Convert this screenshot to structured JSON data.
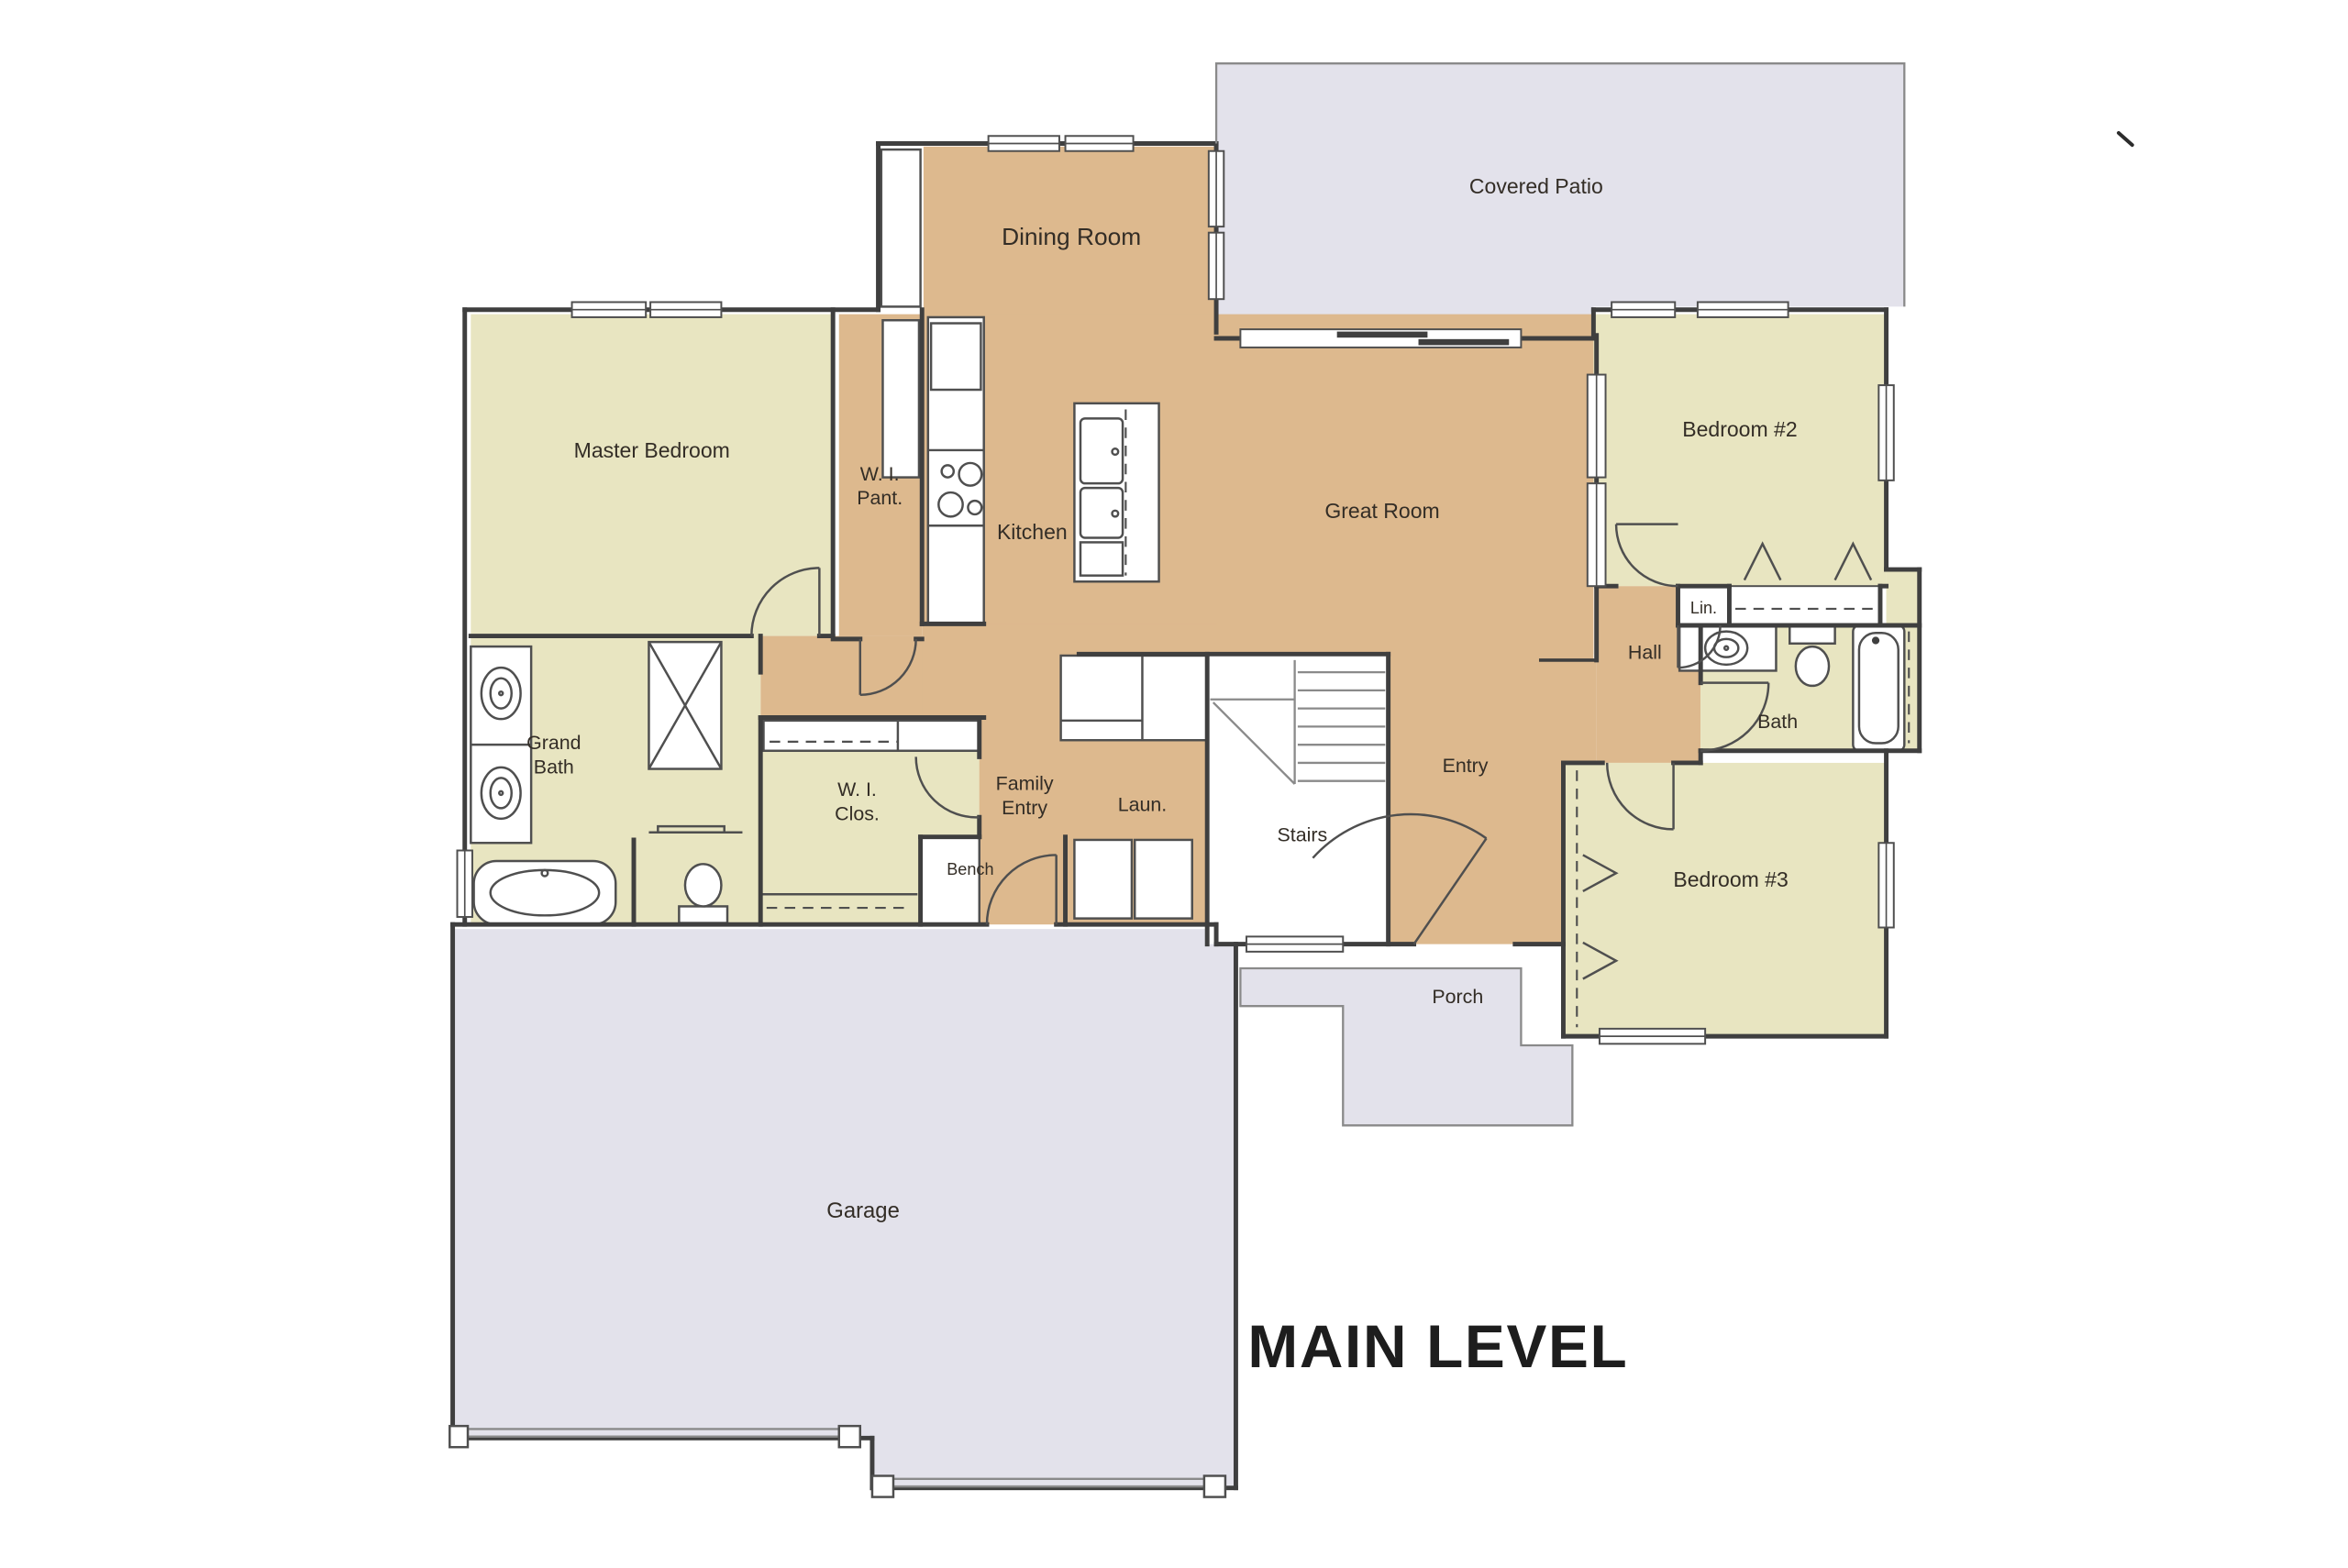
{
  "title": {
    "label": "MAIN LEVEL"
  },
  "rooms": {
    "covered_patio": {
      "label": "Covered Patio"
    },
    "dining_room": {
      "label": "Dining Room"
    },
    "master_bedroom": {
      "label": "Master Bedroom"
    },
    "walk_in_pantry": {
      "label": "W. I.",
      "label2": "Pant."
    },
    "kitchen": {
      "label": "Kitchen"
    },
    "great_room": {
      "label": "Great Room"
    },
    "bedroom_2": {
      "label": "Bedroom #2"
    },
    "linen": {
      "label": "Lin."
    },
    "hall": {
      "label": "Hall"
    },
    "bath": {
      "label": "Bath"
    },
    "grand_bath": {
      "label": "Grand",
      "label2": "Bath"
    },
    "walk_in_closet": {
      "label": "W. I.",
      "label2": "Clos."
    },
    "family_entry": {
      "label": "Family",
      "label2": "Entry"
    },
    "laundry": {
      "label": "Laun."
    },
    "bench": {
      "label": "Bench"
    },
    "stairs": {
      "label": "Stairs"
    },
    "entry": {
      "label": "Entry"
    },
    "bedroom_3": {
      "label": "Bedroom #3"
    },
    "porch": {
      "label": "Porch"
    },
    "garage": {
      "label": "Garage"
    }
  },
  "colors": {
    "tan": "#ddb98e",
    "pale": "#e8e5c1",
    "gray": "#e3e2eb",
    "wall": "#3f3f3f",
    "thin": "#8a8a8a",
    "fix": "#4f4f4f",
    "text": "#332d26",
    "title": "#1d1d1d"
  },
  "fixtures": [
    "sliding-patio-door",
    "dining-hutch",
    "pantry-shelves",
    "refrigerator",
    "range-cooktop",
    "kitchen-island",
    "washer-dryer",
    "laundry-cabinets",
    "stair-treads",
    "bench-seat",
    "shower",
    "freestanding-tub",
    "double-vanity-sinks",
    "master-toilet",
    "towel-bar",
    "closet-rods",
    "linen-closet",
    "bath-sink-counter",
    "bath-toilet",
    "bathtub",
    "front-door",
    "garage-doors",
    "window",
    "door-swing"
  ]
}
